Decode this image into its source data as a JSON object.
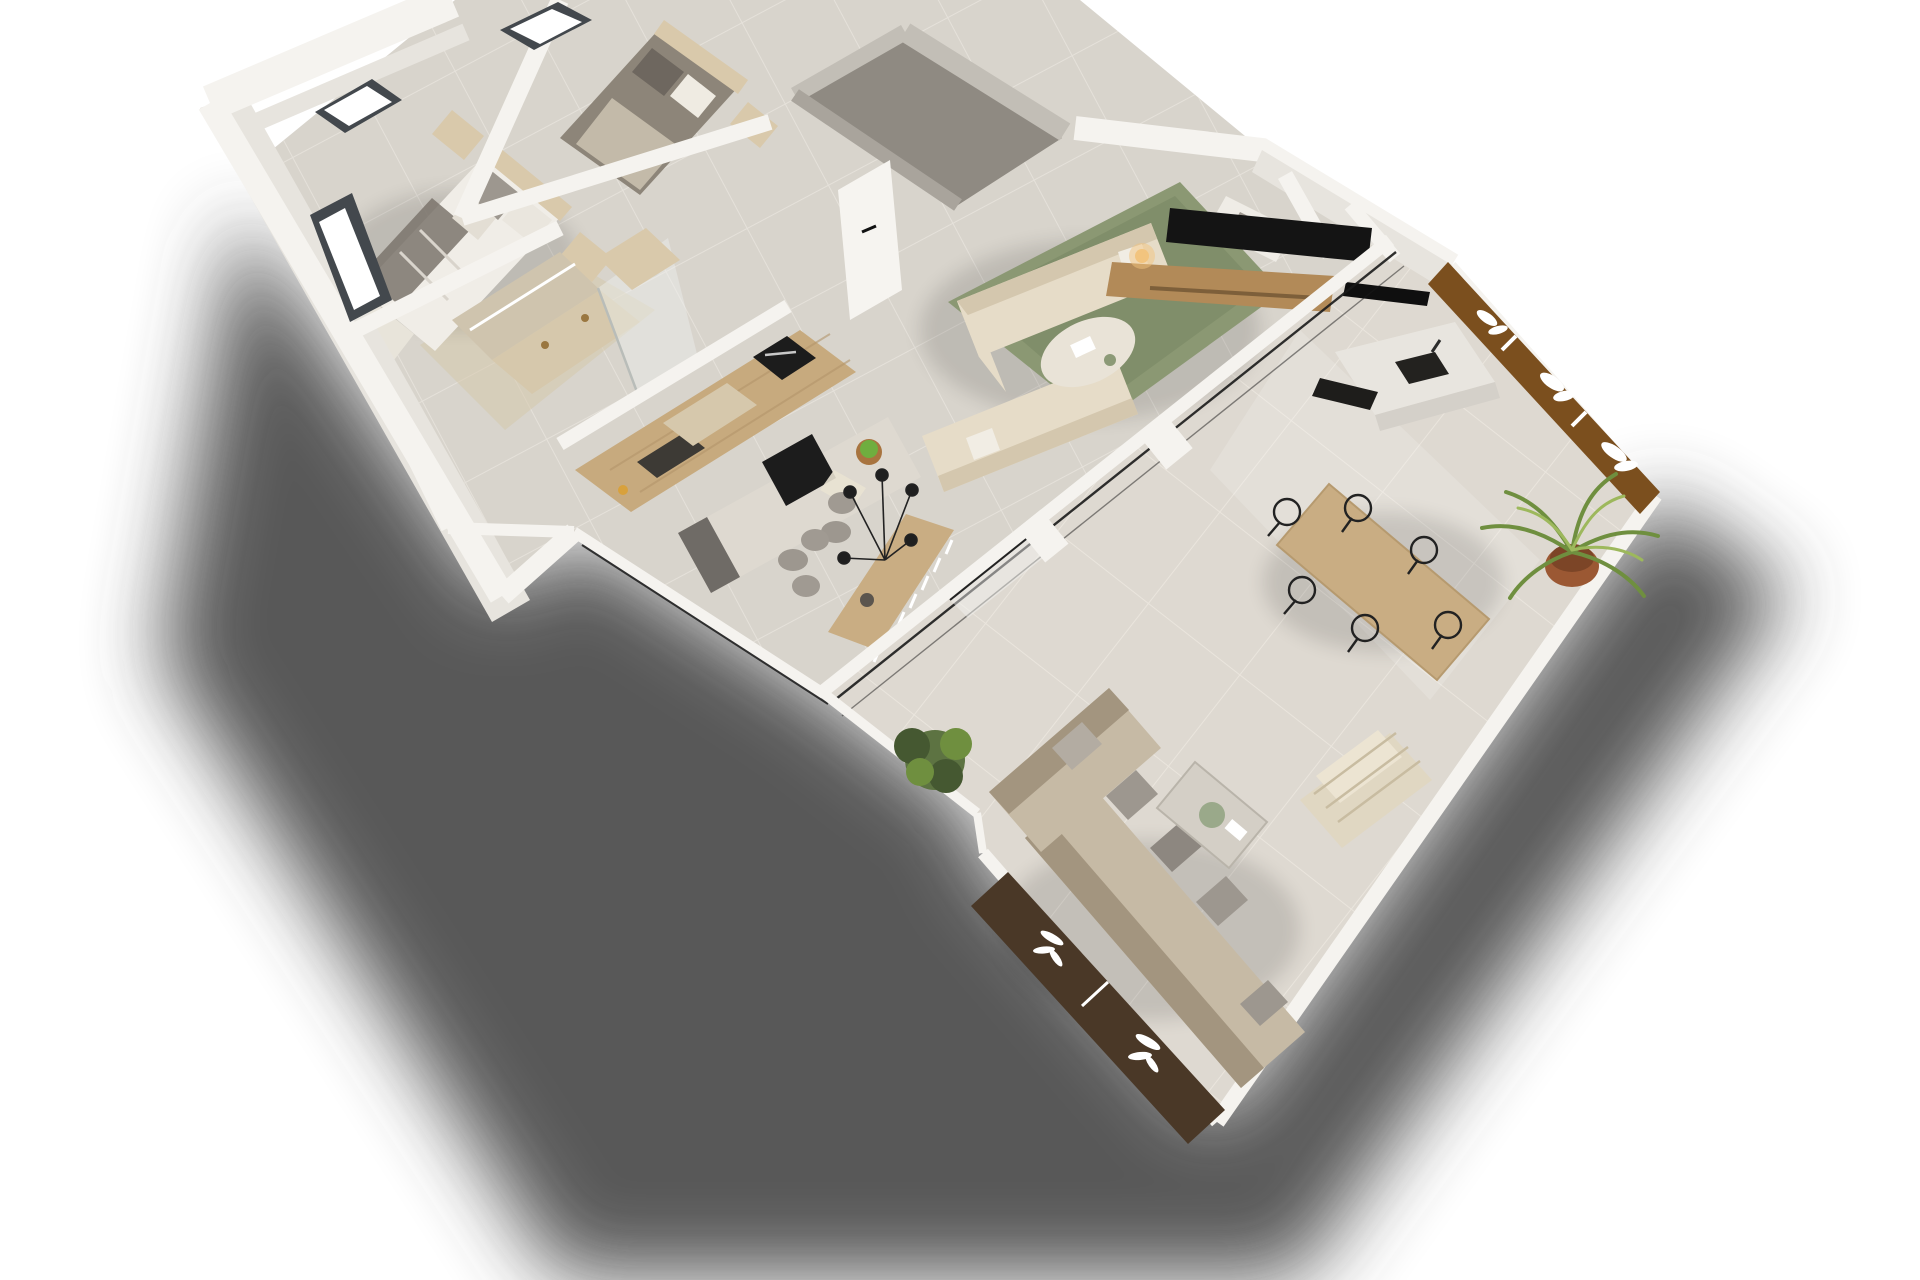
{
  "meta": {
    "render_type": "3d-floor-plan-dollhouse-render",
    "view": "aerial-isometric-rotated",
    "background": "#ffffff"
  },
  "palette": {
    "bg": "#ffffff",
    "shadow": "#424242",
    "wall-top": "#f5f3ef",
    "wall-face": "#e7e4de",
    "wall-shade": "#d8d4cd",
    "concrete-wall": "#c2beb6",
    "concrete-face": "#a9a49c",
    "floor-entry": "#8f8a82",
    "floor-interior": "#d8d4cc",
    "floor-grout": "#e5e1da",
    "floor-terrace": "#ded9d1",
    "terrace-grout": "#eae5dd",
    "travertine": "#d6c8ac",
    "glass-frame": "#1a1a1a",
    "window-frame": "#43484d",
    "wood-cabinet": "#c7aa7e",
    "wood-grain": "#b2946a",
    "wood-console": "#b28a58",
    "wood-table": "#c9ad83",
    "island-top": "#ded9d0",
    "island-dark": "#6f6b66",
    "appliance-black": "#1c1c1c",
    "rug-green": "#8b9873",
    "rug-green-dark": "#6e7c58",
    "sofa-cream": "#e6dcc8",
    "sofa-shade": "#d4c7ae",
    "cushion-gray": "#9d978f",
    "duvet-white": "#f0ede7",
    "duvet-shade": "#d9d4cc",
    "throw-dark": "#7b746c",
    "headboard-tan": "#d9c9ab",
    "bed2-duvet": "#8d8579",
    "outdoor-sofa": "#c6baa5",
    "outdoor-sofa-dark": "#a3957f",
    "pot-terracotta": "#9b5833",
    "plant-green": "#6f8f3f",
    "plant-dark": "#4f6e2d",
    "plant-light": "#9db85c",
    "bush-green": "#5d7342",
    "bush-dark": "#455831",
    "planter-brown": "#7b4f1e",
    "planter-dark": "#4a3827",
    "leaf-white": "#ffffff",
    "lamp-glow": "#f2c47e",
    "metal-black": "#222222",
    "lounger-weave": "#e0d7c2",
    "lounger-line": "#c8bca1",
    "mirror-wall": "#cfc4ae"
  },
  "scene": {
    "rooms": [
      {
        "id": "master-bedroom",
        "furnishings": [
          "double-bed",
          "gray-throw",
          "pillows",
          "nightstands",
          "foot-bench",
          "window-west",
          "window-north"
        ]
      },
      {
        "id": "bedroom-2",
        "furnishings": [
          "double-bed",
          "dark-duvet",
          "pillows",
          "nightstand",
          "window-north"
        ]
      },
      {
        "id": "bathroom",
        "furnishings": [
          "travertine-vanity",
          "mirror-led",
          "brass-taps",
          "glass-shower",
          "wardrobe-cubes"
        ]
      },
      {
        "id": "kitchen",
        "furnishings": [
          "wood-cabinet-run",
          "built-in-oven",
          "sink",
          "island-with-cooktop",
          "fruit-bowl",
          "bar-stools"
        ]
      },
      {
        "id": "dining-nook",
        "furnishings": [
          "wood-table",
          "upholstered-chairs",
          "black-pendant-lamp",
          "white-fringe-decor",
          "vase"
        ]
      },
      {
        "id": "entry-storage",
        "furnishings": [
          "concrete-walls",
          "white-door-black-handle"
        ]
      },
      {
        "id": "living-room",
        "furnishings": [
          "green-rug",
          "cream-sofa-north",
          "cream-sofa-south",
          "oval-coffee-table",
          "tv",
          "wood-tv-console",
          "table-lamp",
          "fireplace-slot",
          "daybed-bench"
        ]
      },
      {
        "id": "terrace",
        "furnishings": [
          "sliding-glass-wall",
          "outdoor-kitchen-sink-counter",
          "grill-counter",
          "corten-planter-screens-leaf-cutouts",
          "wood-dining-table",
          "six-wire-chairs",
          "potted-palm",
          "potted-bush",
          "l-shaped-outdoor-sofa",
          "gray-pillows",
          "outdoor-coffee-table",
          "woven-lounge-chair",
          "dark-planter-boxes-leaf-motifs"
        ]
      }
    ],
    "lighting": [
      "soft-daylight",
      "large-cast-shadow-southeast"
    ]
  }
}
